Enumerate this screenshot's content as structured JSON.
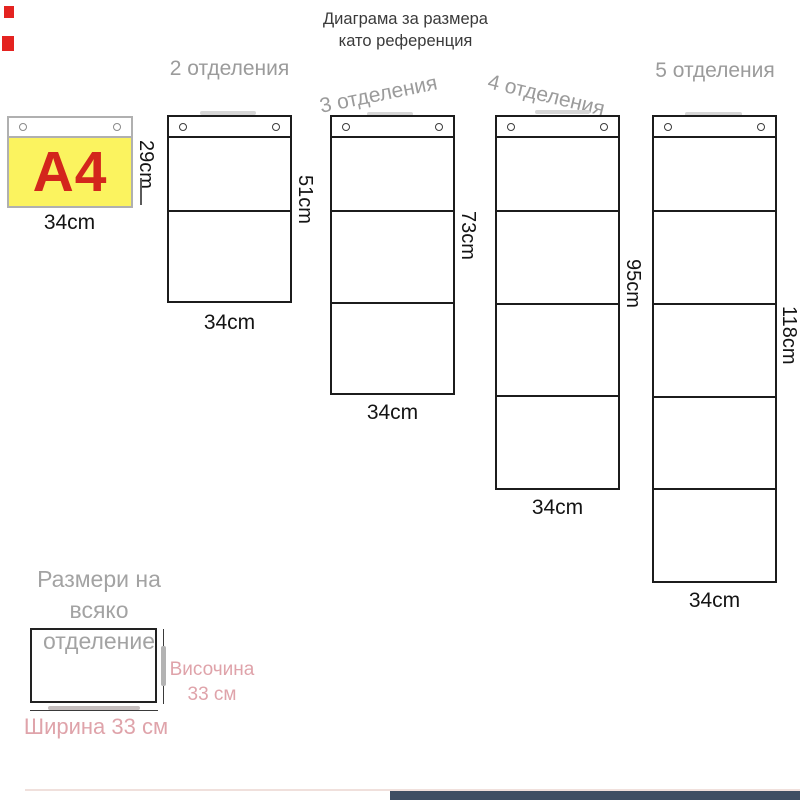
{
  "colors": {
    "a4-yellow": "#fbf35f",
    "a4-red": "#d3261c",
    "label-gray": "#9b9b9b",
    "pink-accent": "#dfa3aa",
    "line-dark": "#1c1c1c",
    "bottom-bar": "#3f4e63",
    "artifact-red": "#e42320"
  },
  "title": {
    "line1": "Диаграма за размера",
    "line2": "като референция"
  },
  "a4_reference": {
    "label": "A4",
    "height_label": "29cm",
    "width_label": "34cm"
  },
  "columns": [
    {
      "label": "2 отделения",
      "compartments": 2,
      "height_label": "51cm",
      "width_label": "34cm"
    },
    {
      "label": "3 отделения",
      "compartments": 3,
      "height_label": "73cm",
      "width_label": "34cm"
    },
    {
      "label": "4 отделения",
      "compartments": 4,
      "height_label": "95cm",
      "width_label": "34cm"
    },
    {
      "label": "5 отделения",
      "compartments": 5,
      "height_label": "118cm",
      "width_label": "34cm"
    }
  ],
  "detail": {
    "heading": "Размери на всяко отделение",
    "height_label": "Височина 33 см",
    "width_label": "Ширина 33 см"
  }
}
